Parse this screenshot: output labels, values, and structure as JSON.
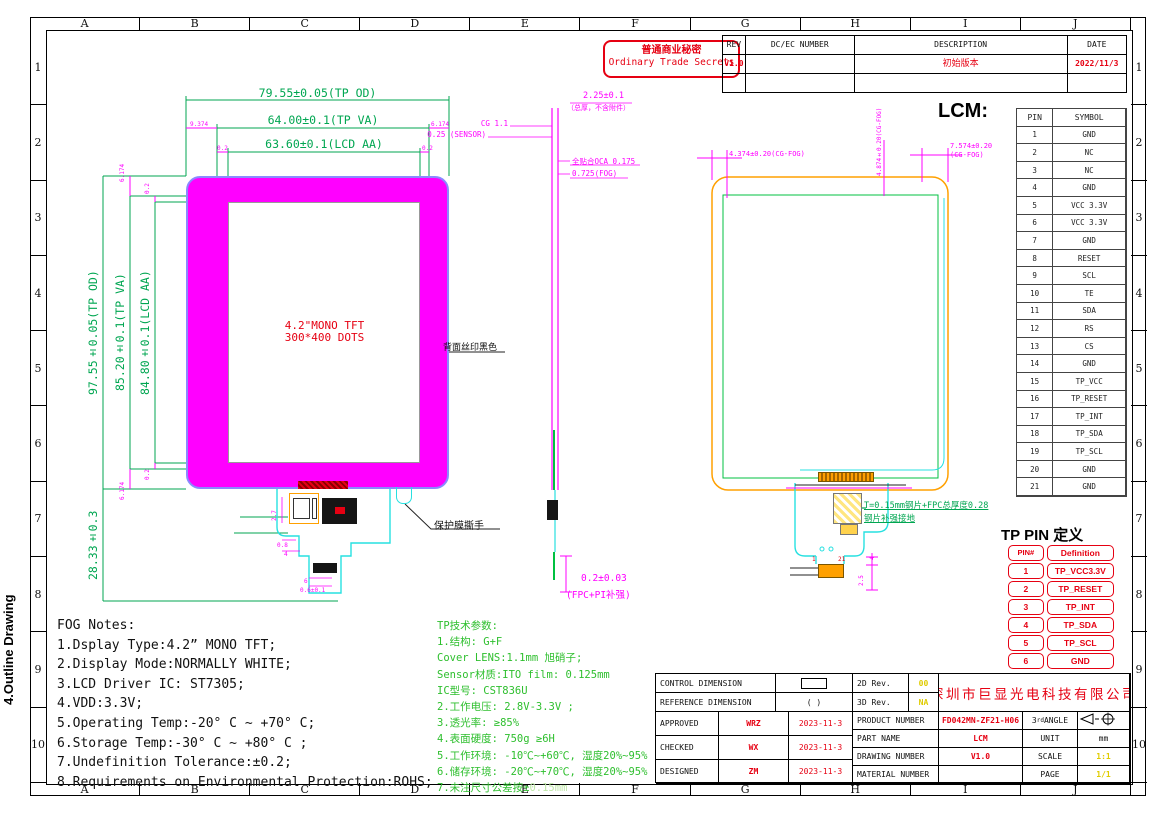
{
  "side_label": "4.Outline Drawing",
  "colors": {
    "magenta": "#FF00FF",
    "dim_green": "#00A651",
    "param_green": "#2EBF2E",
    "cyan": "#27E0E0",
    "orange": "#FFA000",
    "red": "#E60012",
    "yellow": "#E0CC00"
  },
  "grid": {
    "cols": [
      "A",
      "B",
      "C",
      "D",
      "E",
      "F",
      "G",
      "H",
      "I",
      "J"
    ],
    "rows": [
      "1",
      "2",
      "3",
      "4",
      "5",
      "6",
      "7",
      "8",
      "9",
      "10"
    ]
  },
  "stamp": {
    "line1": "普通商业秘密",
    "line2": "Ordinary Trade Secrets"
  },
  "revision": {
    "headers": [
      "REV",
      "DC/EC NUMBER",
      "DESCRIPTION",
      "DATE"
    ],
    "rows": [
      {
        "rev": "V1.0",
        "dcec": "",
        "desc": "初始版本",
        "date": "2022/11/3"
      },
      {
        "rev": "",
        "dcec": "",
        "desc": "",
        "date": ""
      }
    ]
  },
  "lcm": {
    "title": "LCM:",
    "headers": [
      "PIN",
      "SYMBOL"
    ],
    "pins": [
      {
        "pin": "1",
        "sym": "GND"
      },
      {
        "pin": "2",
        "sym": "NC"
      },
      {
        "pin": "3",
        "sym": "NC"
      },
      {
        "pin": "4",
        "sym": "GND"
      },
      {
        "pin": "5",
        "sym": "VCC 3.3V"
      },
      {
        "pin": "6",
        "sym": "VCC 3.3V"
      },
      {
        "pin": "7",
        "sym": "GND"
      },
      {
        "pin": "8",
        "sym": "RESET"
      },
      {
        "pin": "9",
        "sym": "SCL"
      },
      {
        "pin": "10",
        "sym": "TE"
      },
      {
        "pin": "11",
        "sym": "SDA"
      },
      {
        "pin": "12",
        "sym": "RS"
      },
      {
        "pin": "13",
        "sym": "CS"
      },
      {
        "pin": "14",
        "sym": "GND"
      },
      {
        "pin": "15",
        "sym": "TP_VCC"
      },
      {
        "pin": "16",
        "sym": "TP_RESET"
      },
      {
        "pin": "17",
        "sym": "TP_INT"
      },
      {
        "pin": "18",
        "sym": "TP_SDA"
      },
      {
        "pin": "19",
        "sym": "TP_SCL"
      },
      {
        "pin": "20",
        "sym": "GND"
      },
      {
        "pin": "21",
        "sym": "GND"
      }
    ]
  },
  "tp_pin": {
    "title": "TP PIN 定义",
    "headers": [
      "PIN#",
      "Definition"
    ],
    "pins": [
      {
        "pin": "1",
        "def": "TP_VCC3.3V"
      },
      {
        "pin": "2",
        "def": "TP_RESET"
      },
      {
        "pin": "3",
        "def": "TP_INT"
      },
      {
        "pin": "4",
        "def": "TP_SDA"
      },
      {
        "pin": "5",
        "def": "TP_SCL"
      },
      {
        "pin": "6",
        "def": "GND"
      }
    ]
  },
  "front_view": {
    "dim_tp_od_w": "79.55±0.05(TP OD)",
    "dim_tp_va_w": "64.00±0.1(TP VA)",
    "dim_lcd_aa_w": "63.60±0.1(LCD AA)",
    "dim_tp_od_h": "97.55±0.05(TP OD)",
    "dim_tp_va_h": "85.20±0.1(TP VA)",
    "dim_lcd_aa_h": "84.80±0.1(LCD AA)",
    "dim_fpc_h": "28.33±0.3",
    "off_left": "9.374",
    "off_right": "6.174",
    "off_top": "6.174",
    "off_bottom": "6.174",
    "off_aa": "0.2",
    "center_line1": "4.2\"MONO TFT",
    "center_line2": "300*400 DOTS",
    "back_silkscreen": "背面丝印黑色",
    "film_tab": "保护膜撕手",
    "small_dims": [
      "2.7",
      "0.8",
      "4",
      "6",
      "0.6±0.1"
    ]
  },
  "side_view": {
    "total": "2.25±0.1",
    "total_note": "（总厚，不含附件）",
    "cg": "CG 1.1",
    "sensor": "0.25 (SENSOR)",
    "oca": "全贴合OCA 0.175",
    "fog": "0.725(FOG)",
    "fpc": "0.2±0.03",
    "fpc_note": "(FPC+PI补强)"
  },
  "back_view": {
    "dim_left": "4.374±0.20(CG-FOG)",
    "dim_mid": "4.874±0.20(CG-FOG)",
    "dim_right1": "7.574±0.20",
    "dim_right2": "(CG-FOG)",
    "steel_note1": "T=0.15mm钢片+FPC总厚度0.28",
    "steel_note2": "钢片补强接地",
    "pin_first": "1",
    "pin_last": "21",
    "dim_conn_w": "4",
    "dim_conn_h": "2.5"
  },
  "fog_notes": {
    "title": "FOG Notes:",
    "items": [
      "1.Dsplay Type:4.2” MONO TFT;",
      "2.Display Mode:NORMALLY WHITE;",
      "3.LCD Driver IC: ST7305;",
      "4.VDD:3.3V;",
      "5.Operating Temp:-20° C ~ +70° C;",
      "6.Storage Temp:-30° C ~ +80° C ;",
      "7.Undefinition Tolerance:±0.2;",
      "8.Requirements on Environmental Protection:ROHS;"
    ]
  },
  "tp_params": {
    "title": "TP技术参数:",
    "items": [
      "1.结构: G+F",
      "Cover LENS:1.1mm 旭硝子;",
      "Sensor材质:ITO film: 0.125mm",
      "IC型号: CST836U",
      "2.工作电压: 2.8V-3.3V ;",
      "3.透光率: ≥85%",
      "4.表面硬度: 750g ≥6H",
      "5.工作环境: -10℃~+60℃, 湿度20%~95%",
      "6.储存环境: -20℃~+70℃, 湿度20%~95%"
    ],
    "last_prefix": "7.未注尺寸公差按±",
    "last_hl": "0.15mm"
  },
  "title_block": {
    "control_dim": "CONTROL DIMENSION",
    "reference_dim": "REFERENCE DIMENSION",
    "ref_symbol": "(   )",
    "approved_l": "APPROVED",
    "approved_v": "WRZ",
    "approved_d": "2023-11-3",
    "checked_l": "CHECKED",
    "checked_v": "WX",
    "checked_d": "2023-11-3",
    "designed_l": "DESIGNED",
    "designed_v": "ZM",
    "designed_d": "2023-11-3",
    "rev2d_l": "2D Rev.",
    "rev2d_v": "00",
    "rev3d_l": "3D Rev.",
    "rev3d_v": "NA",
    "company": "深圳市巨显光电科技有限公司",
    "product_number_l": "PRODUCT NUMBER",
    "product_number_v": "FD042MN-ZF21-H06",
    "angle_num": "3",
    "angle_sup": "rd",
    "angle_word": " ANGLE",
    "part_name_l": "PART NAME",
    "part_name_v": "LCM",
    "unit_l": "UNIT",
    "unit_v": "mm",
    "drawing_number_l": "DRAWING NUMBER",
    "drawing_number_v": "V1.0",
    "scale_l": "SCALE",
    "scale_v": "1:1",
    "material_number_l": "MATERIAL NUMBER",
    "material_number_v": "",
    "page_l": "PAGE",
    "page_v": "1/1"
  }
}
